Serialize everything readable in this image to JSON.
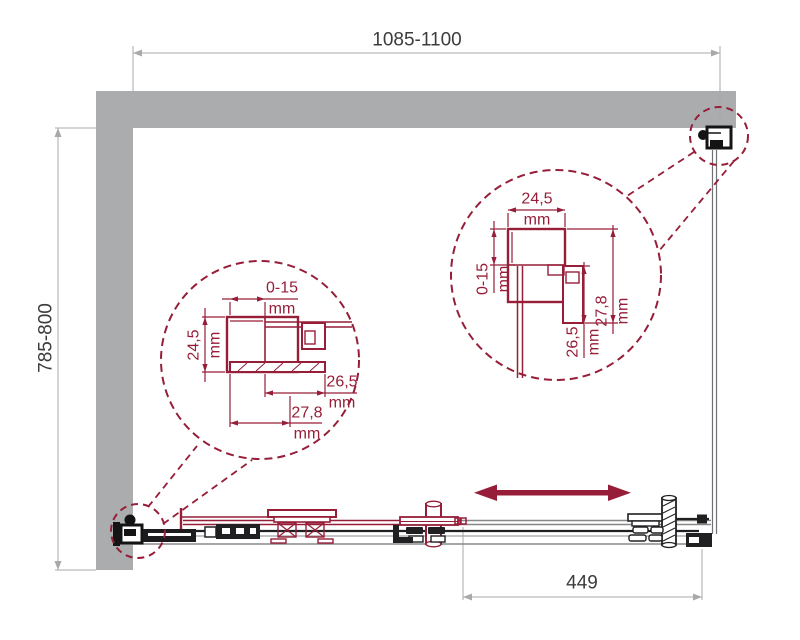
{
  "diagram": {
    "kind": "shower-enclosure-installation-drawing",
    "view": "top-view"
  },
  "colors": {
    "accent_red": "#961e38",
    "wall_gray": "#aaacae",
    "dim_line_gray": "#a8a9ab",
    "text_dark": "#3c3c3e",
    "hardware_black": "#1c1c1e"
  },
  "dims": {
    "width": "1085-1100",
    "depth": "785-800",
    "opening": "449"
  },
  "detail_left": {
    "top_value": "0-15",
    "top_unit": "mm",
    "left_value": "24,5",
    "left_unit": "mm",
    "right_value": "26,5",
    "right_unit": "mm",
    "bottom_value": "27,8",
    "bottom_unit": "mm"
  },
  "detail_right": {
    "top_value": "24,5",
    "top_unit": "mm",
    "left_value": "0-15",
    "left_unit": "mm",
    "right_value": "27,8",
    "right_unit": "mm",
    "mid_value": "26,5",
    "mid_unit": "mm"
  },
  "icons": {
    "slide_direction": "double-headed-arrow",
    "callouts": "dashed-detail-circle"
  }
}
